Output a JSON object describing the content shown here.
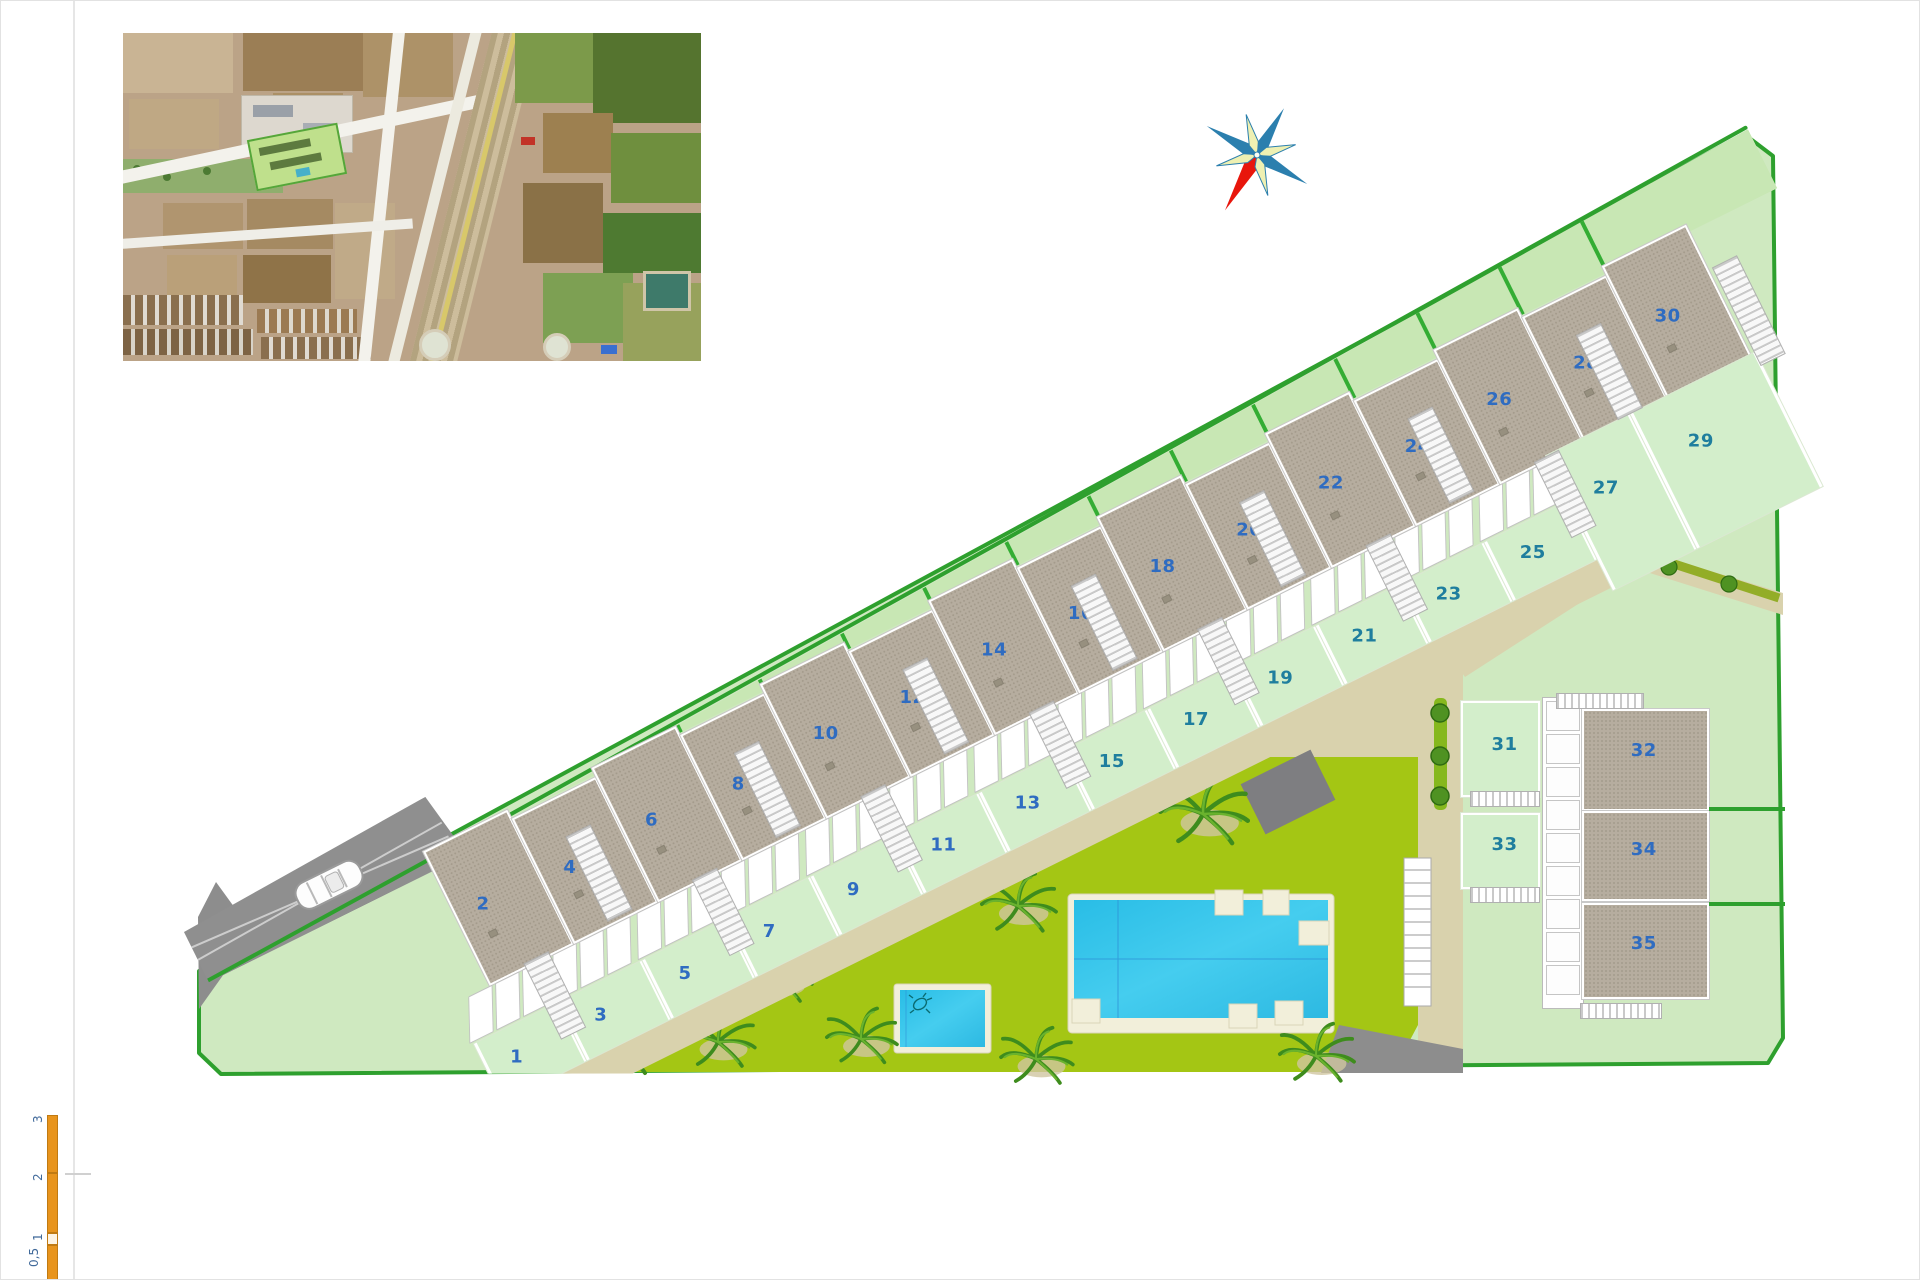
{
  "plots": {
    "strip": [
      {
        "roof": "2",
        "garden": "1"
      },
      {
        "roof": "4",
        "garden": "3"
      },
      {
        "roof": "6",
        "garden": "5"
      },
      {
        "roof": "8",
        "garden": "7"
      },
      {
        "roof": "10",
        "garden": "9"
      },
      {
        "roof": "12",
        "garden": "11"
      },
      {
        "roof": "14",
        "garden": "13"
      },
      {
        "roof": "16",
        "garden": "15"
      },
      {
        "roof": "18",
        "garden": "17"
      },
      {
        "roof": "20",
        "garden": "19"
      },
      {
        "roof": "22",
        "garden": "21"
      },
      {
        "roof": "24",
        "garden": "23"
      },
      {
        "roof": "26",
        "garden": "25"
      },
      {
        "roof": "28",
        "garden": "27"
      },
      {
        "roof": "30",
        "garden": "29"
      }
    ],
    "cluster_gardens": [
      "31",
      "33"
    ],
    "cluster_roofs": [
      "32",
      "34",
      "35"
    ]
  },
  "scale_bar": {
    "labels": [
      "3",
      "2",
      "1",
      "0,5"
    ]
  },
  "icons": {
    "compass": "compass-rose",
    "car": "car-top-view",
    "palm": "palm-tree",
    "turtle": "sea-turtle",
    "aerial_inset": "aerial-photo-inset"
  },
  "colors": {
    "site_green": "#cfe9c0",
    "boundary_green": "#2ea02e",
    "divider_green": "#34ad34",
    "communal_lime": "#a4c614",
    "garden_green": "#d3eecb",
    "roof_gray": "#b6ad9f",
    "path_tan": "#d9d2ad",
    "pool_blue": "#2ec2e8",
    "deck_cream": "#f2efda",
    "road_gray": "#8f8f8f",
    "label_blue": "#2f6cc1",
    "label_teal": "#1f7e9e",
    "scale_orange": "#e8941c"
  }
}
